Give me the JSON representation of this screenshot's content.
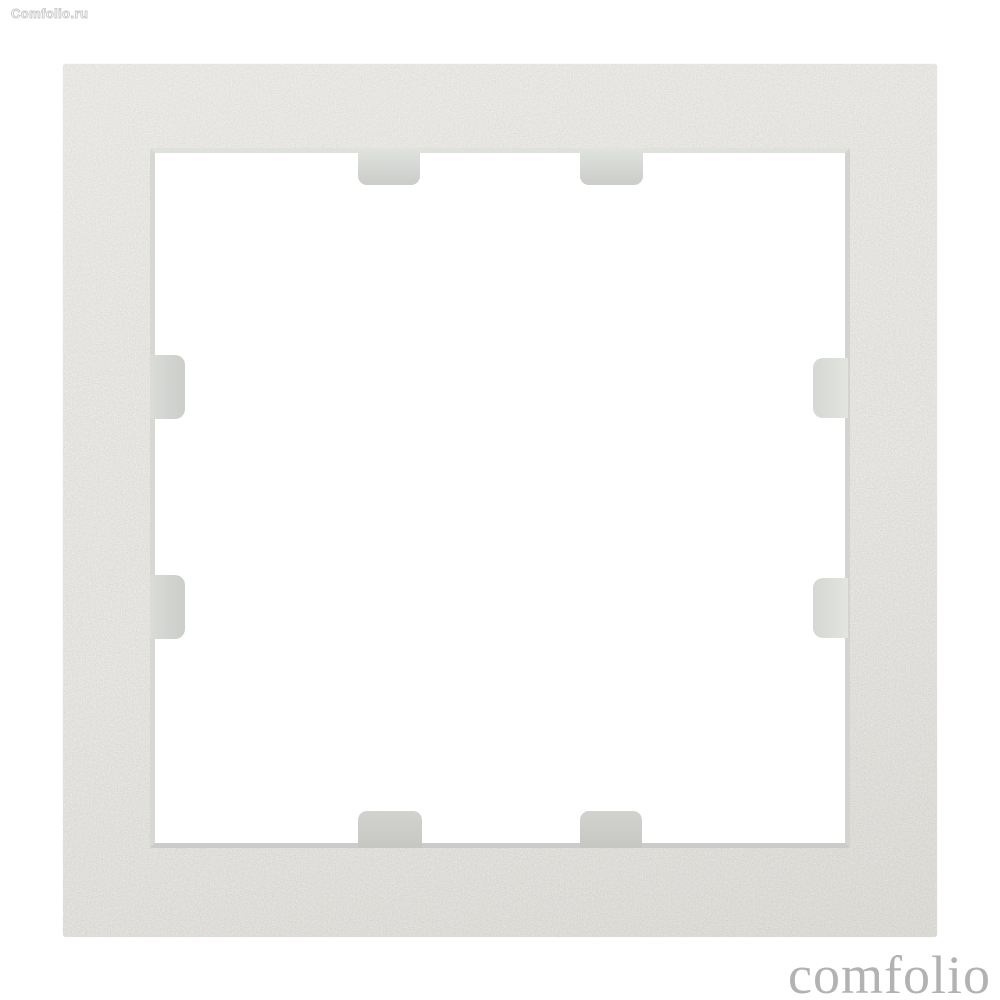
{
  "page": {
    "background_color": "#ffffff"
  },
  "watermark": {
    "site_label": "Comfolio.ru",
    "brand_label": "comfolio",
    "brand_color": "#b2b2b2"
  },
  "product": {
    "description": "Silver metallic square single-gang wall switch frame, front view on white background",
    "frame_color": "#c6c3be",
    "frame_sparkle_color": "#e9e6e2",
    "frame_dark_speck_color": "#b2afab",
    "bevel_color": "#d5d7d3",
    "clip_color": "#d5d8d4",
    "window_color": "#ffffff",
    "clip_count": 8
  }
}
